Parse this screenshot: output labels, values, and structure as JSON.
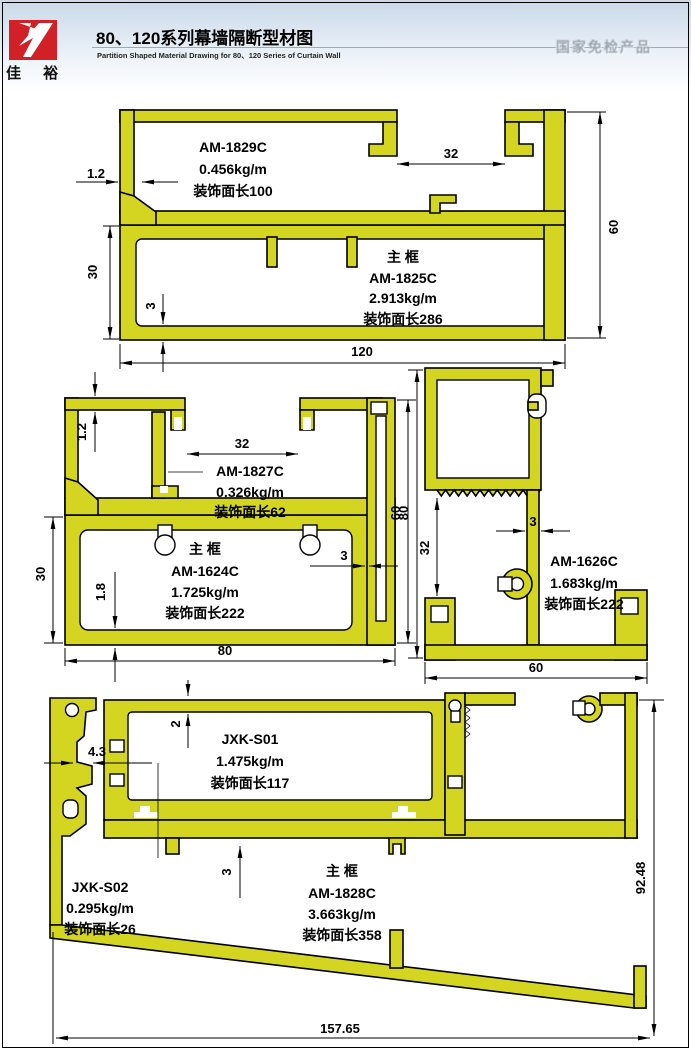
{
  "header": {
    "logo_chars": "佳 裕",
    "title": "80、120系列幕墙隔断型材图",
    "subtitle": "Partition Shaped Material Drawing for 80、120 Series of Curtain Wall",
    "watermark": "国家免检产品"
  },
  "colors": {
    "profile_fill": "#d4d520",
    "logo_red": "#d22027",
    "line": "#000000"
  },
  "profiles": {
    "p1_insert": {
      "model": "AM-1829C",
      "weight": "0.456kg/m",
      "face_len": "装饰面长100"
    },
    "p1_main": {
      "role": "主  框",
      "model": "AM-1825C",
      "weight": "2.913kg/m",
      "face_len": "装饰面长286"
    },
    "p2_insert": {
      "model": "AM-1827C",
      "weight": "0.326kg/m",
      "face_len": "装饰面长62"
    },
    "p2_main": {
      "role": "主  框",
      "model": "AM-1624C",
      "weight": "1.725kg/m",
      "face_len": "装饰面长222"
    },
    "p3_main": {
      "model": "AM-1626C",
      "weight": "1.683kg/m",
      "face_len": "装饰面长222"
    },
    "p4_insert": {
      "model": "JXK-S01",
      "weight": "1.475kg/m",
      "face_len": "装饰面长117"
    },
    "p4_side": {
      "model": "JXK-S02",
      "weight": "0.295kg/m",
      "face_len": "装饰面长26"
    },
    "p4_main": {
      "role": "主  框",
      "model": "AM-1828C",
      "weight": "3.663kg/m",
      "face_len": "装饰面长358"
    }
  },
  "dims": {
    "p1_wall": "1.2",
    "p1_slot": "32",
    "p1_height": "60",
    "p1_box": "30",
    "p1_bottom": "3",
    "p1_width": "120",
    "p2_wall": "1.2",
    "p2_slot": "32",
    "p2_height": "60",
    "p2_box": "30",
    "p2_bottom": "1.8",
    "p2_side": "3",
    "p2_width": "80",
    "p3_height": "80",
    "p3_inner": "32",
    "p3_stem": "3",
    "p3_width": "60",
    "p4_wall": "2",
    "p4_side": "4.3",
    "p4_bottom": "3",
    "p4_height": "92.48",
    "p4_width": "157.65"
  }
}
